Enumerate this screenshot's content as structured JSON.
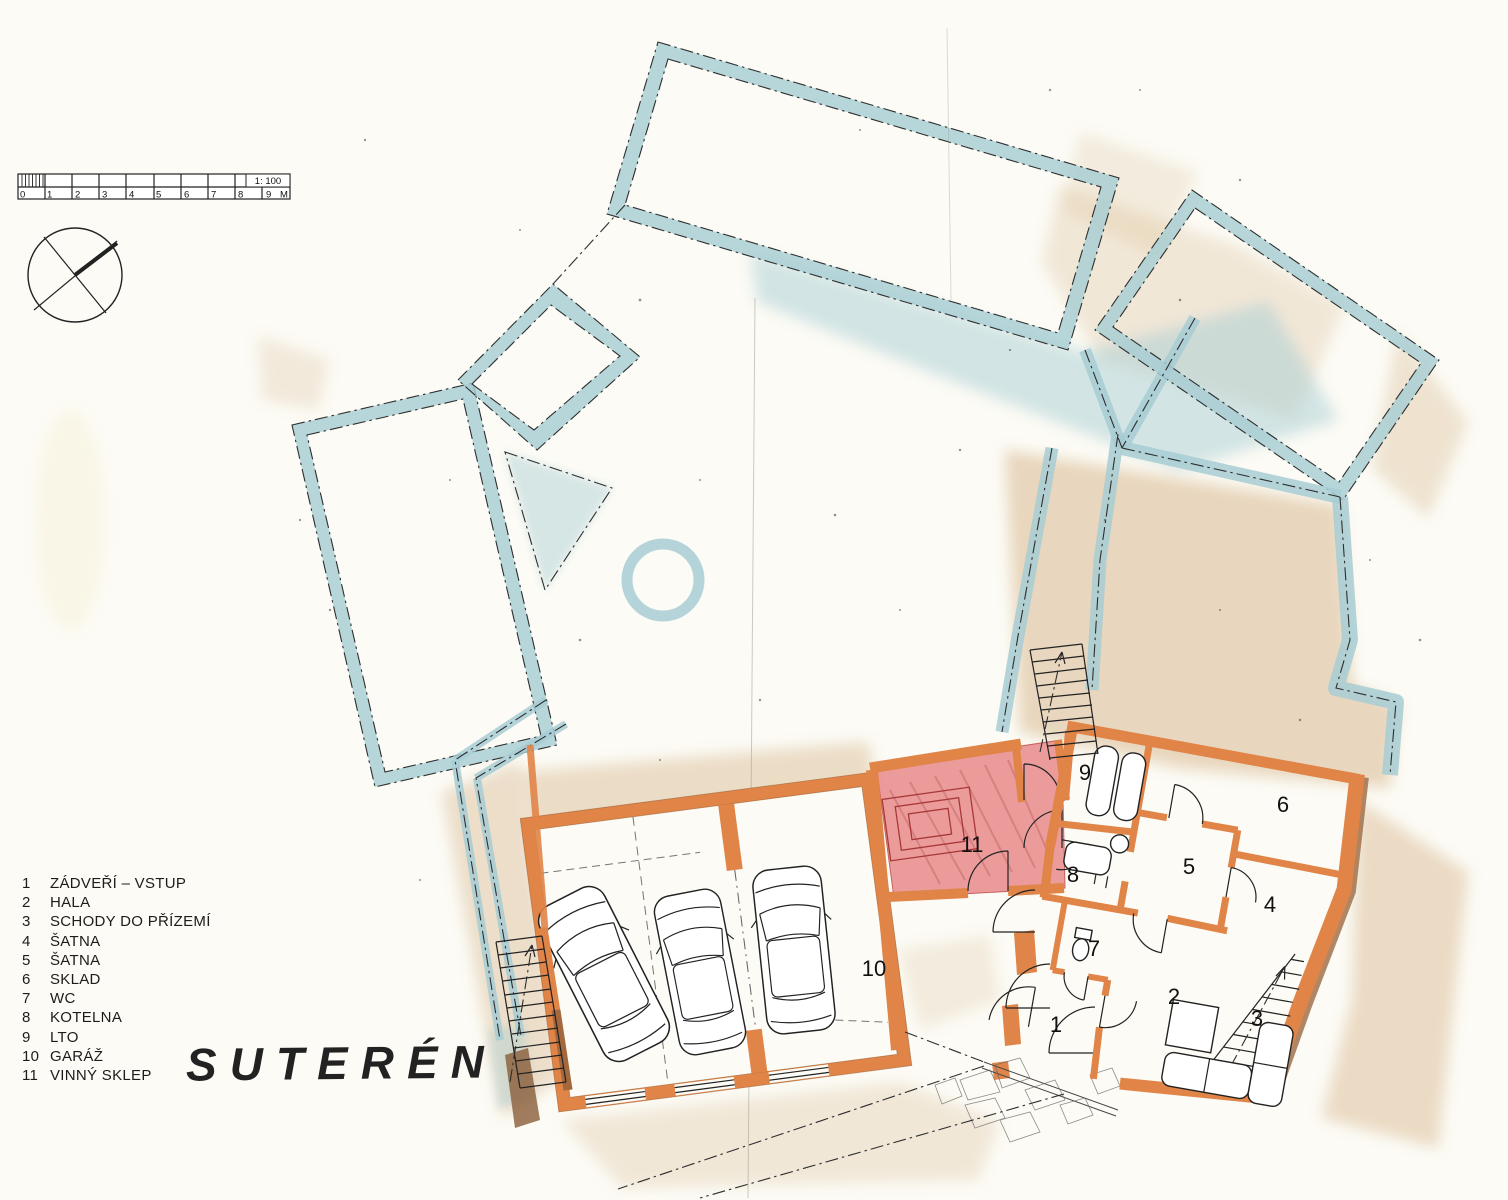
{
  "title": "SUTERÉN",
  "scale_bar": {
    "ratio_label": "1: 100",
    "unit_label": "M",
    "tick_labels": [
      "0",
      "1",
      "2",
      "3",
      "4",
      "5",
      "6",
      "7",
      "8",
      "9"
    ]
  },
  "legend": {
    "items": [
      {
        "num": "1",
        "label": "ZÁDVEŘÍ – VSTUP"
      },
      {
        "num": "2",
        "label": "HALA"
      },
      {
        "num": "3",
        "label": "SCHODY DO PŘÍZEMÍ"
      },
      {
        "num": "4",
        "label": "ŠATNA"
      },
      {
        "num": "5",
        "label": "ŠATNA"
      },
      {
        "num": "6",
        "label": "SKLAD"
      },
      {
        "num": "7",
        "label": "WC"
      },
      {
        "num": "8",
        "label": "KOTELNA"
      },
      {
        "num": "9",
        "label": "LTO"
      },
      {
        "num": "10",
        "label": "GARÁŽ"
      },
      {
        "num": "11",
        "label": "VINNÝ SKLEP"
      }
    ]
  },
  "plan": {
    "room_numbers": [
      "1",
      "2",
      "3",
      "4",
      "5",
      "6",
      "7",
      "8",
      "9",
      "10",
      "11"
    ],
    "car_count": 3
  },
  "colors": {
    "upper_floor_walls": "#a7cdd3",
    "basement_walls": "#e08448",
    "wine_cellar_fill": "#e89191",
    "paper": "#fcfbf5"
  },
  "icons": {
    "compass": "compass-rose",
    "north_stair_arrow": "up-arrow",
    "west_stair_arrow": "up-arrow"
  }
}
